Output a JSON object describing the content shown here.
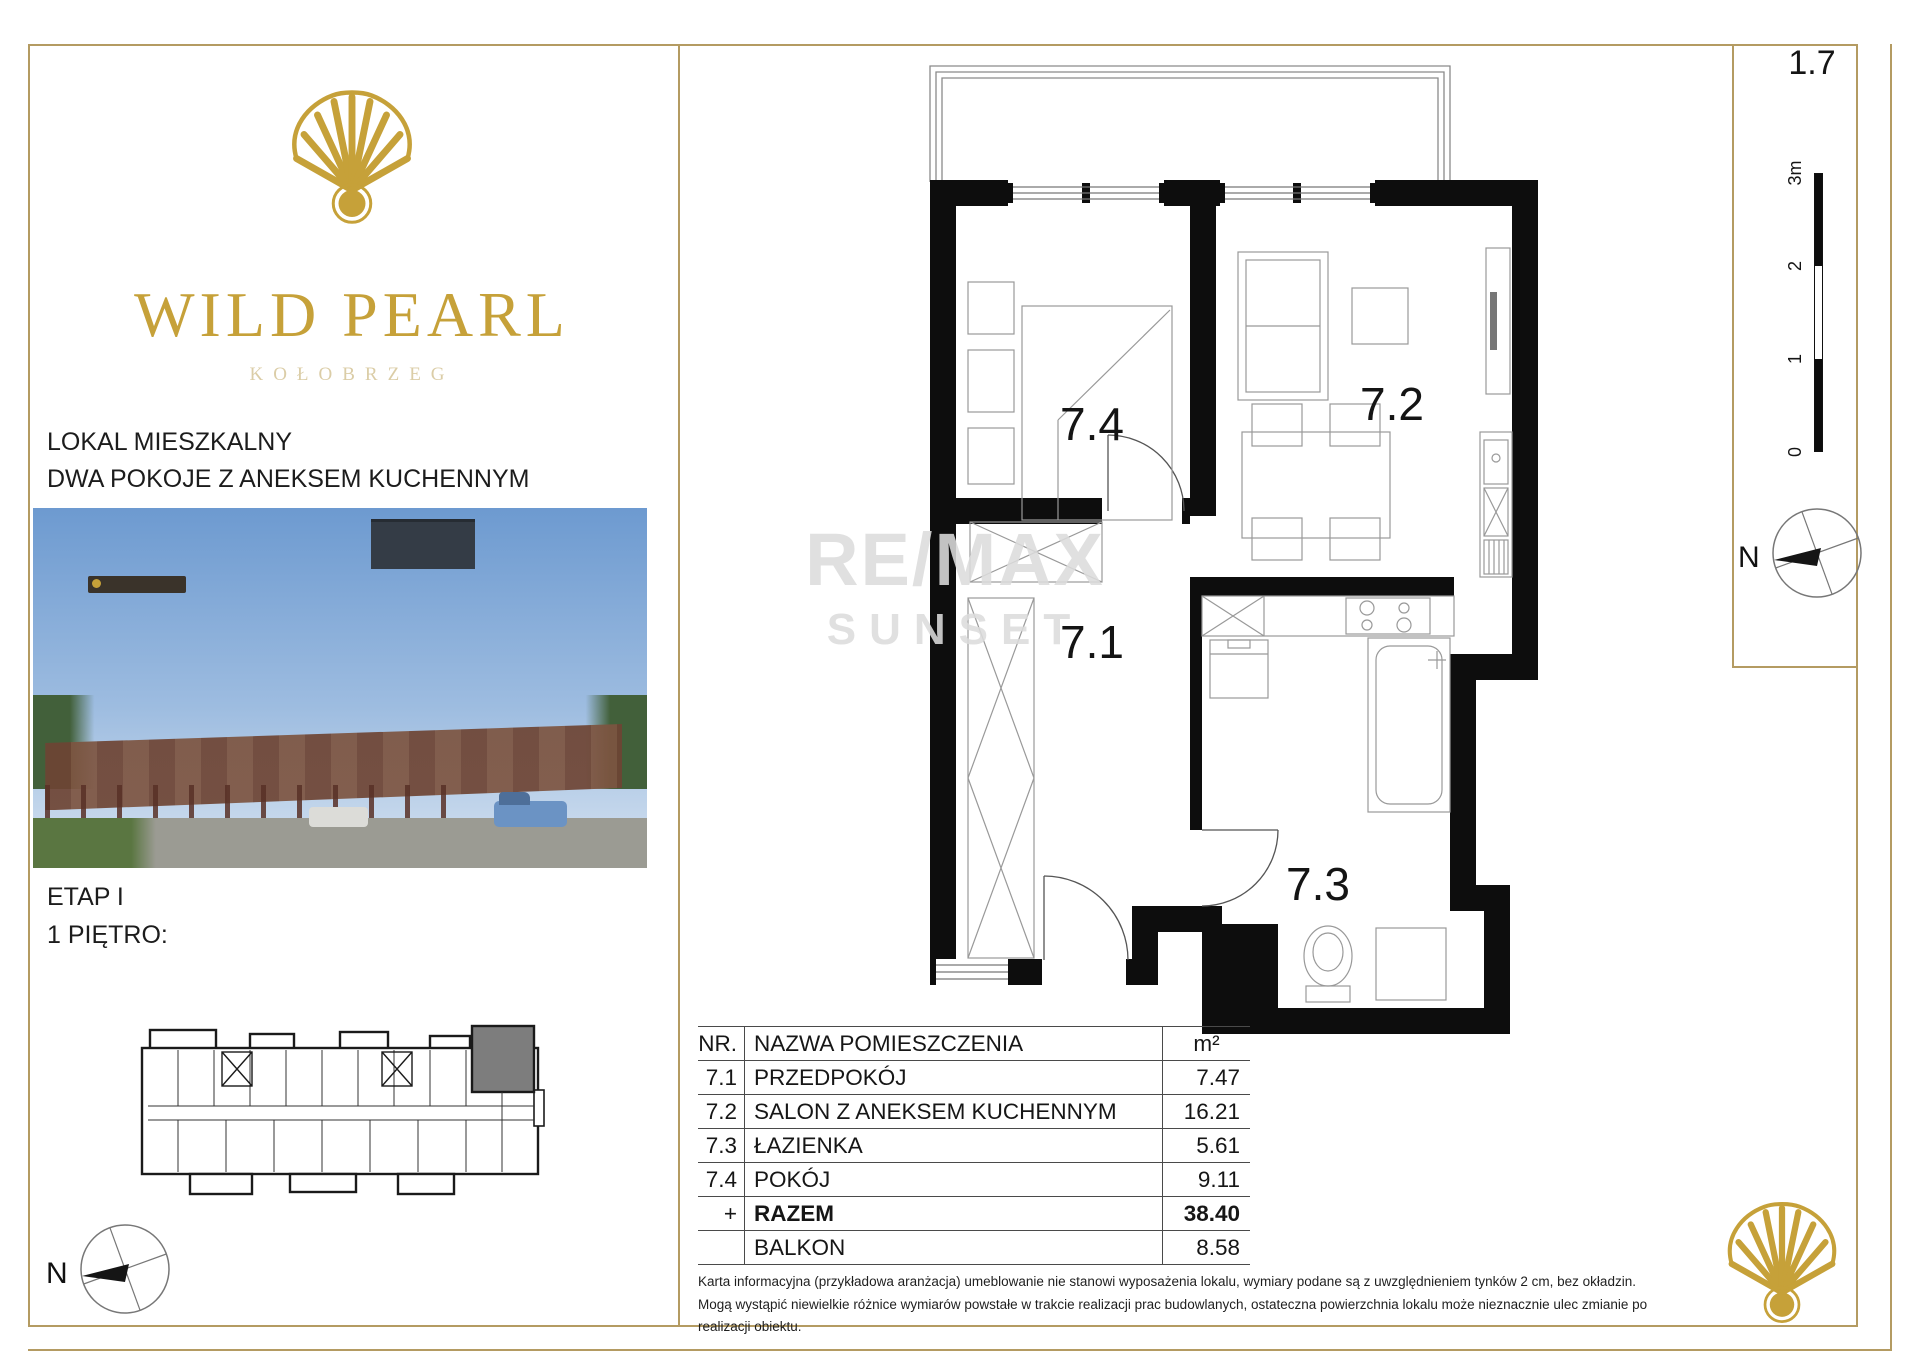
{
  "brand": {
    "name": "WILD PEARL",
    "city": "KOŁOBRZEG"
  },
  "left_panel": {
    "listing_type": "LOKAL MIESZKALNY",
    "listing_subtitle": "DWA POKOJE Z ANEKSEM KUCHENNYM",
    "stage": "ETAP I",
    "floor": "1 PIĘTRO:"
  },
  "plan": {
    "number": "1.7",
    "labels": {
      "hall": "7.1",
      "living": "7.2",
      "bath": "7.3",
      "room": "7.4"
    },
    "watermark": {
      "line1": "RE/MAX",
      "line2": "SUNSET"
    }
  },
  "scale_bar": {
    "ticks": [
      "3m",
      "2",
      "1",
      "0"
    ]
  },
  "compass": {
    "label": "N"
  },
  "area_table": {
    "headers": {
      "nr": "NR.",
      "name": "NAZWA POMIESZCZENIA",
      "unit": "m²"
    },
    "rows": [
      {
        "nr": "7.1",
        "name": "PRZEDPOKÓJ",
        "area": "7.47"
      },
      {
        "nr": "7.2",
        "name": "SALON Z ANEKSEM KUCHENNYM",
        "area": "16.21"
      },
      {
        "nr": "7.3",
        "name": "ŁAZIENKA",
        "area": "5.61"
      },
      {
        "nr": "7.4",
        "name": "POKÓJ",
        "area": "9.11"
      }
    ],
    "total": {
      "nr": "+",
      "name": "RAZEM",
      "area": "38.40"
    },
    "balcony": {
      "name": "BALKON",
      "area": "8.58"
    }
  },
  "disclaimer": {
    "line1": "Karta informacyjna (przykładowa aranżacja) umeblowanie nie stanowi wyposażenia lokalu, wymiary podane są z uwzględnieniem tynków 2 cm, bez okładzin.",
    "line2": "Mogą wystąpić niewielkie różnice wymiarów powstałe w trakcie realizacji prac budowlanych, ostateczna powierzchnia lokalu może nieznacznie ulec zmianie po realizacji obiektu."
  },
  "colors": {
    "gold": "#c6a139",
    "gold_border": "#b49b62",
    "faded_gold": "#dbcda7",
    "wall_black": "#0d0d0d",
    "highlighted_unit": "#7d7d7d"
  }
}
